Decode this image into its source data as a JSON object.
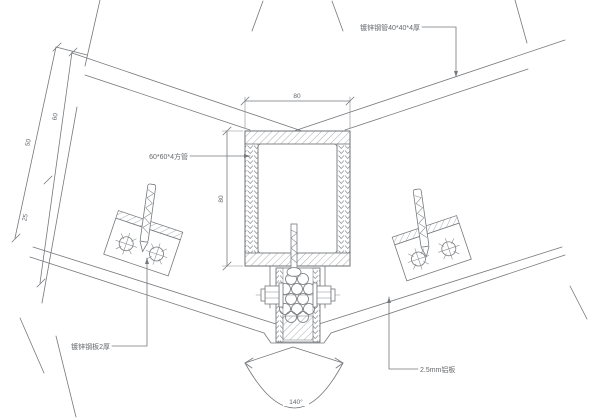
{
  "drawing": {
    "type": "curtain-wall ridge / valley joint construction detail (section)",
    "labels": {
      "tube_profile": "60*60*4方管",
      "top_right_member": "镀锌钢管40*40*4厚",
      "bottom_left_plate": "镀锌钢板2厚",
      "bottom_right_panel": "2.5mm铝板"
    },
    "dimensions": {
      "tube_width": "80",
      "tube_height": "80",
      "slope_offset_a": "60",
      "slope_offset_b": "50",
      "slope_offset_c": "25"
    },
    "angle_label": "140°",
    "colors": {
      "line": "#75787c",
      "text": "#64676b",
      "background": "#ffffff"
    }
  }
}
